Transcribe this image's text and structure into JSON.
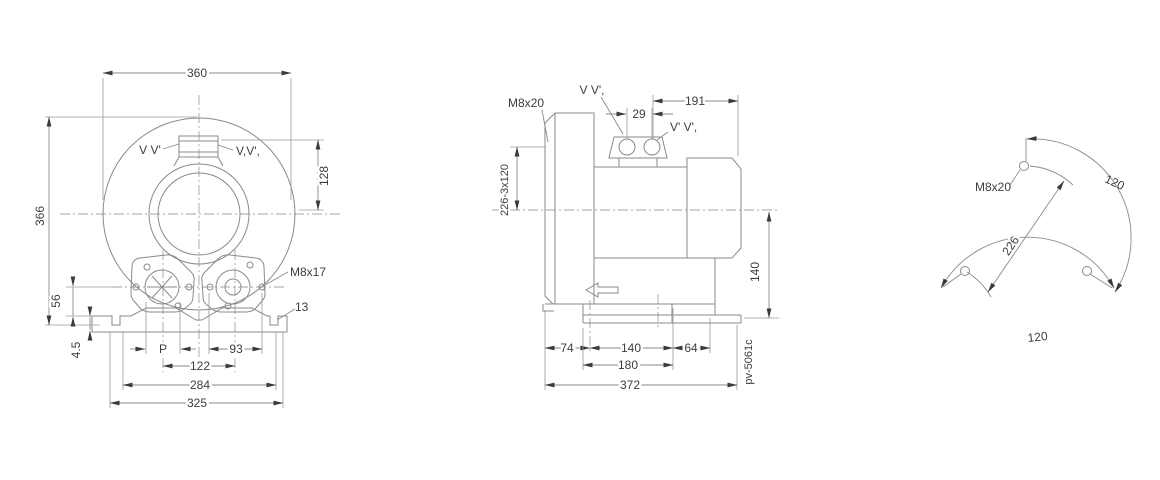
{
  "drawing": {
    "front_view": {
      "dim_overall_width": "360",
      "dim_overall_height": "366",
      "dim_port_height": "128",
      "dim_port_center_height": "56",
      "dim_foot_plate": "4.5",
      "dim_port_bore": "P",
      "dim_flange_bolt_span": "93",
      "dim_port_spacing": "122",
      "dim_foot_hole_span": "284",
      "dim_base_width": "325",
      "label_thread": "M8x17",
      "label_foot_slot": "13",
      "label_port_left": "V V'",
      "label_port_right": "V,V',"
    },
    "side_view": {
      "label_thread": "M8x20",
      "label_bolt_circle": "226-3x120",
      "label_port_top": "V V',",
      "label_port_right": "V' V',",
      "dim_port_holes": "29",
      "dim_motor_length": "191",
      "dim_axis_height": "140",
      "dim_foot_left": "74",
      "dim_foot_mid": "140",
      "dim_foot_right": "64",
      "dim_foot_width": "180",
      "dim_total_length": "372",
      "doc_number": "pv-5061c"
    },
    "flange_view": {
      "label_thread": "M8x20",
      "dim_bolt_circle": "226",
      "dim_angle_right": "120",
      "dim_angle_bottom": "120"
    }
  }
}
